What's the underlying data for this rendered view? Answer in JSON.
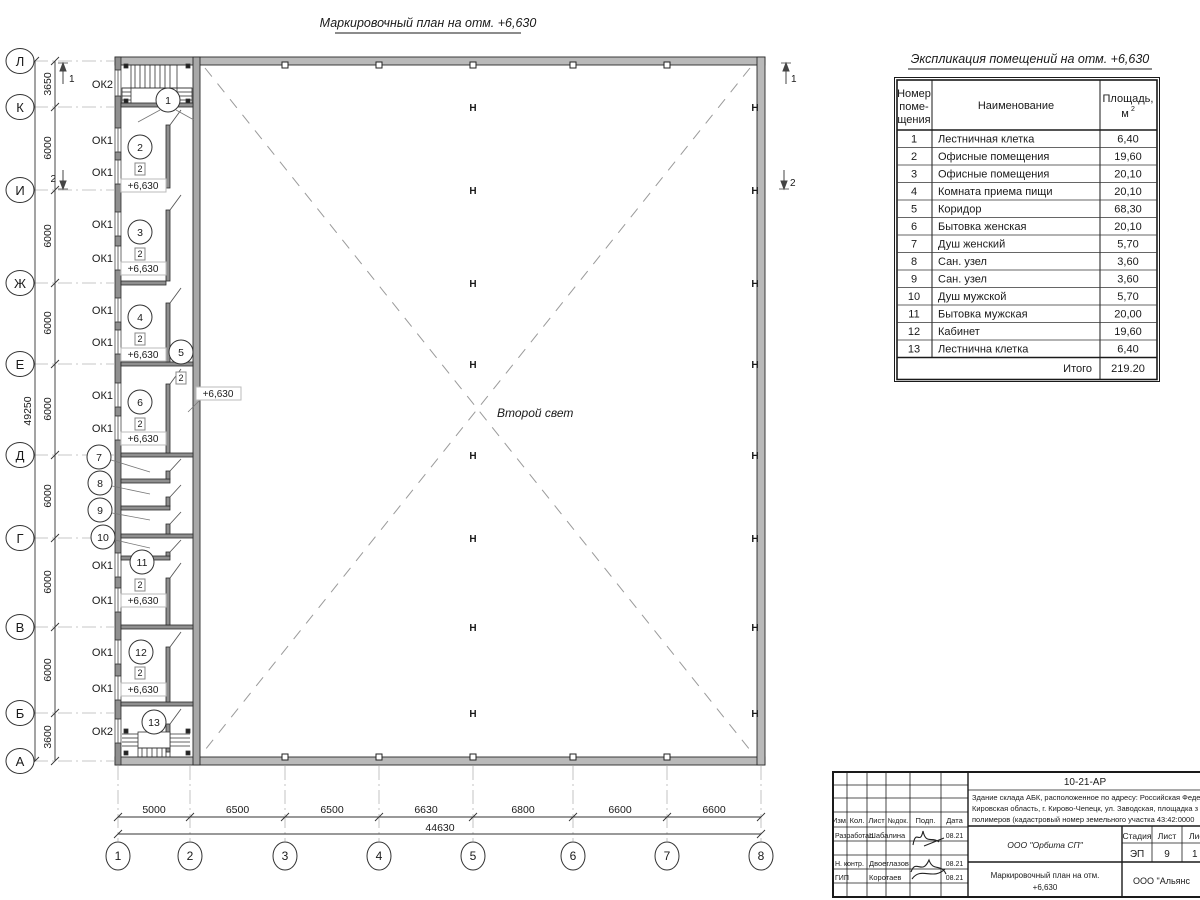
{
  "drawing_title": "Маркировочный план на отм. +6,630",
  "expl": {
    "title": "Экспликация помещений на отм. +6,630",
    "h_num1": "Номер",
    "h_num2": "поме-",
    "h_num3": "щения",
    "h_name": "Наименование",
    "h_area1": "Площадь,",
    "h_area_m": "м",
    "h_area_sup": "2",
    "rows": [
      {
        "n": "1",
        "name": "Лестничная клетка",
        "area": "6,40"
      },
      {
        "n": "2",
        "name": "Офисные помещения",
        "area": "19,60"
      },
      {
        "n": "3",
        "name": "Офисные помещения",
        "area": "20,10"
      },
      {
        "n": "4",
        "name": "Комната приема пищи",
        "area": "20,10"
      },
      {
        "n": "5",
        "name": "Коридор",
        "area": "68,30"
      },
      {
        "n": "6",
        "name": "Бытовка женская",
        "area": "20,10"
      },
      {
        "n": "7",
        "name": "Душ женский",
        "area": "5,70"
      },
      {
        "n": "8",
        "name": "Сан. узел",
        "area": "3,60"
      },
      {
        "n": "9",
        "name": "Сан. узел",
        "area": "3,60"
      },
      {
        "n": "10",
        "name": "Душ мужской",
        "area": "5,70"
      },
      {
        "n": "11",
        "name": "Бытовка мужская",
        "area": "20,00"
      },
      {
        "n": "12",
        "name": "Кабинет",
        "area": "19,60"
      },
      {
        "n": "13",
        "name": "Лестнична клетка",
        "area": "6,40"
      }
    ],
    "total_label": "Итого",
    "total_value": "219.20"
  },
  "axes": {
    "letters": [
      "Л",
      "К",
      "И",
      "Ж",
      "Е",
      "Д",
      "Г",
      "В",
      "Б",
      "А"
    ],
    "numbers": [
      "1",
      "2",
      "3",
      "4",
      "5",
      "6",
      "7",
      "8"
    ]
  },
  "dims": {
    "left_top": "3650",
    "left_mid": "6000",
    "left_bottom": "3600",
    "left_total": "49250",
    "bottom": [
      "5000",
      "6500",
      "6500",
      "6630",
      "6800",
      "6600",
      "6600"
    ],
    "bottom_total": "44630"
  },
  "plan": {
    "ok1": "ОК1",
    "ok2": "ОК2",
    "level": "+6,630",
    "floor_type": "2",
    "column_mark": "Н",
    "second_light": "Второй свет",
    "rooms": [
      "1",
      "2",
      "3",
      "4",
      "5",
      "6",
      "7",
      "8",
      "9",
      "10",
      "11",
      "12",
      "13"
    ],
    "section_1": "1",
    "section_2": "2"
  },
  "titleblock": {
    "code": "10-21-АР",
    "desc1": "Здание склада АБК, расположенное по адресу: Российская Феде",
    "desc2": "Кировская область, г. Кирово-Чепецк, ул. Заводская, площадка з",
    "desc3": "полимеров (кадастровый номер земельного участка 43:42:0000",
    "col_izm": "Изм.",
    "col_kol": "Кол.",
    "col_list": "Лист",
    "col_ndoc": "№док.",
    "col_podp": "Подп.",
    "col_data": "Дата",
    "r1_role": "Разработал",
    "r1_name": "Шабалина",
    "r1_date": "08.21",
    "r2_role": "Н. контр.",
    "r2_name": "Двоеглазов",
    "r2_date": "08.21",
    "r3_role": "ГИП",
    "r3_name": "Коротаев",
    "r3_date": "08.21",
    "org": "ООО \"Орбита СП\"",
    "stage_label": "Стадия",
    "list_label": "Лист",
    "listov_label": "Листов",
    "stage": "ЭП",
    "list_num": "9",
    "listov_num": "1",
    "doc_title1": "Маркировочный план на отм.",
    "doc_title2": "+6,630",
    "org2": "ООО \"Альянс"
  }
}
